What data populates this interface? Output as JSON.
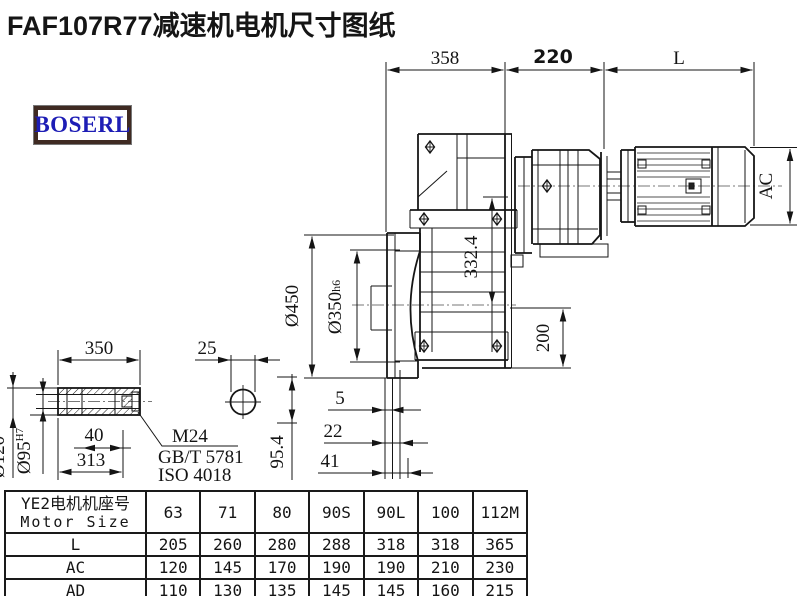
{
  "title": "FAF107R77减速机电机尺寸图纸",
  "logo": {
    "text": "BOSERL"
  },
  "drawing": {
    "dims": {
      "len_gearbox": "358",
      "len_adapter": "220",
      "len_motor": "L",
      "motor_height": "AC",
      "axis_height": "332.4",
      "flange_od": "Ø450",
      "flange_spigot": "Ø350",
      "flange_spigot_tol": "h6",
      "base_height": "200",
      "shaft_len": "350",
      "shaft_dia_small": "25",
      "bolt_len": "40",
      "shaft_len2": "313",
      "hub_od": "Ø120",
      "bore": "Ø95",
      "bore_tol": "H7",
      "center_height": "95.4",
      "face_off1": "5",
      "face_off2": "22",
      "face_off3": "41",
      "thread": "M24",
      "std1": "GB/T 5781",
      "std2": "ISO 4018"
    }
  },
  "table": {
    "header_cn": "YE2电机机座号",
    "header_en": "Motor Size",
    "frame_sizes": [
      "63",
      "71",
      "80",
      "90S",
      "90L",
      "100",
      "112M"
    ],
    "rows": [
      {
        "label": "L",
        "values": [
          "205",
          "260",
          "280",
          "288",
          "318",
          "318",
          "365"
        ]
      },
      {
        "label": "AC",
        "values": [
          "120",
          "145",
          "170",
          "190",
          "190",
          "210",
          "230"
        ]
      },
      {
        "label": "AD",
        "values": [
          "110",
          "130",
          "135",
          "145",
          "145",
          "160",
          "215"
        ]
      }
    ]
  }
}
